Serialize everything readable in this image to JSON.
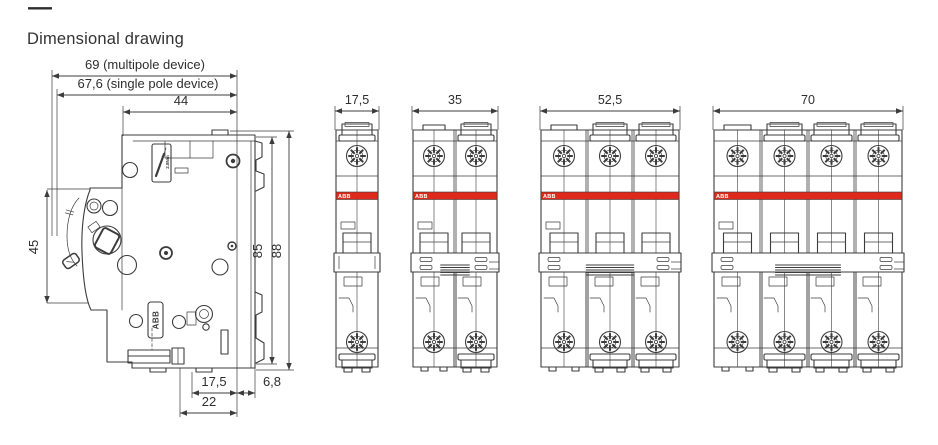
{
  "title": {
    "dash": "—",
    "text": "Dimensional drawing"
  },
  "colors": {
    "abb_red": "#dd2a1d",
    "line": "#3c3c3c",
    "text": "#2e2e2e",
    "background": "#ffffff"
  },
  "side_view": {
    "description": "side profile of miniature circuit breaker",
    "dims": {
      "width_multipole": "69 (multipole device)",
      "width_single_pole": "67,6 (single pole device)",
      "depth_to_rail": "44",
      "handle_height": "45",
      "height_to_rail": "85",
      "height_overall": "88",
      "rail_center_offset": "17,5",
      "rail_clip_depth": "6,8",
      "rail_seat_width": "22"
    },
    "labels": {
      "brand_plate": "ABB",
      "torque_marking": "2.8Nm"
    }
  },
  "front_views": {
    "brand_label": "ABB",
    "items": [
      {
        "id": "1-pole",
        "poles": 1,
        "width_label": "17,5"
      },
      {
        "id": "2-pole",
        "poles": 2,
        "width_label": "35"
      },
      {
        "id": "3-pole",
        "poles": 3,
        "width_label": "52,5"
      },
      {
        "id": "4-pole",
        "poles": 4,
        "width_label": "70"
      }
    ]
  }
}
